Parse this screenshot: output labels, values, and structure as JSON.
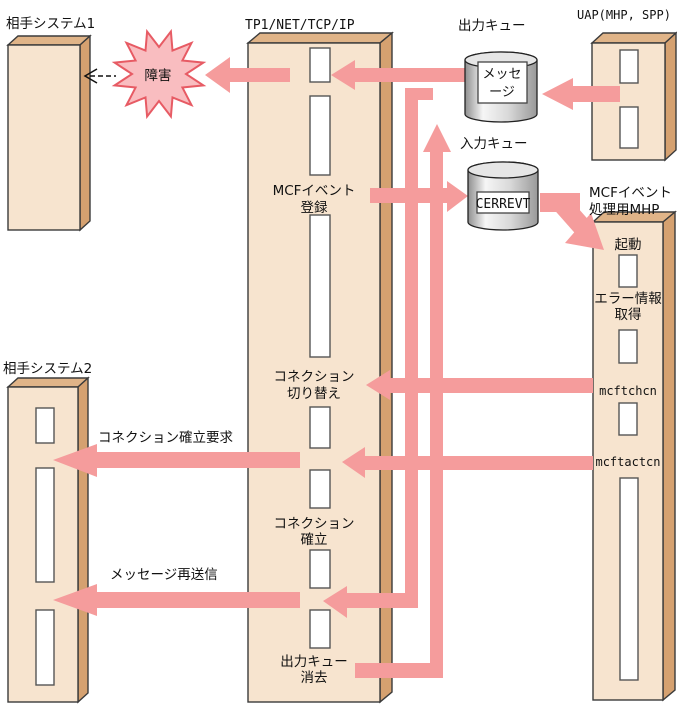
{
  "diagram": {
    "partner_system_1": {
      "title": "相手システム1"
    },
    "partner_system_2": {
      "title": "相手システム2"
    },
    "tp1": {
      "title": "TP1/NET/TCP/IP",
      "labels": {
        "mcf_event_register": [
          "MCFイベント",
          "登録"
        ],
        "connection_switch": [
          "コネクション",
          "切り替え"
        ],
        "connection_establish": [
          "コネクション",
          "確立"
        ],
        "output_queue_delete": [
          "出力キュー",
          "消去"
        ]
      }
    },
    "uap": {
      "title": "UAP(MHP, SPP)"
    },
    "mhp": {
      "title": [
        "MCFイベント",
        "処理用MHP"
      ],
      "labels": {
        "start": "起動",
        "error_info": [
          "エラー情報",
          "取得"
        ],
        "mcftchcn": "mcftchcn",
        "mcftactcn": "mcftactcn"
      }
    },
    "output_queue": {
      "title": "出力キュー",
      "content": [
        "メッセ",
        "ージ"
      ]
    },
    "input_queue": {
      "title": "入力キュー",
      "content": "CERREVT"
    },
    "annotations": {
      "failure": "障害",
      "connection_request": "コネクション確立要求",
      "message_resend": "メッセージ再送信"
    },
    "colors": {
      "arrow": "#F59C9C",
      "burst_fill": "#F9BDC0",
      "burst_border": "#E75B64",
      "box_fill": "#F7E4CF",
      "box_top": "#E0B488",
      "box_side": "#D5A170"
    }
  }
}
